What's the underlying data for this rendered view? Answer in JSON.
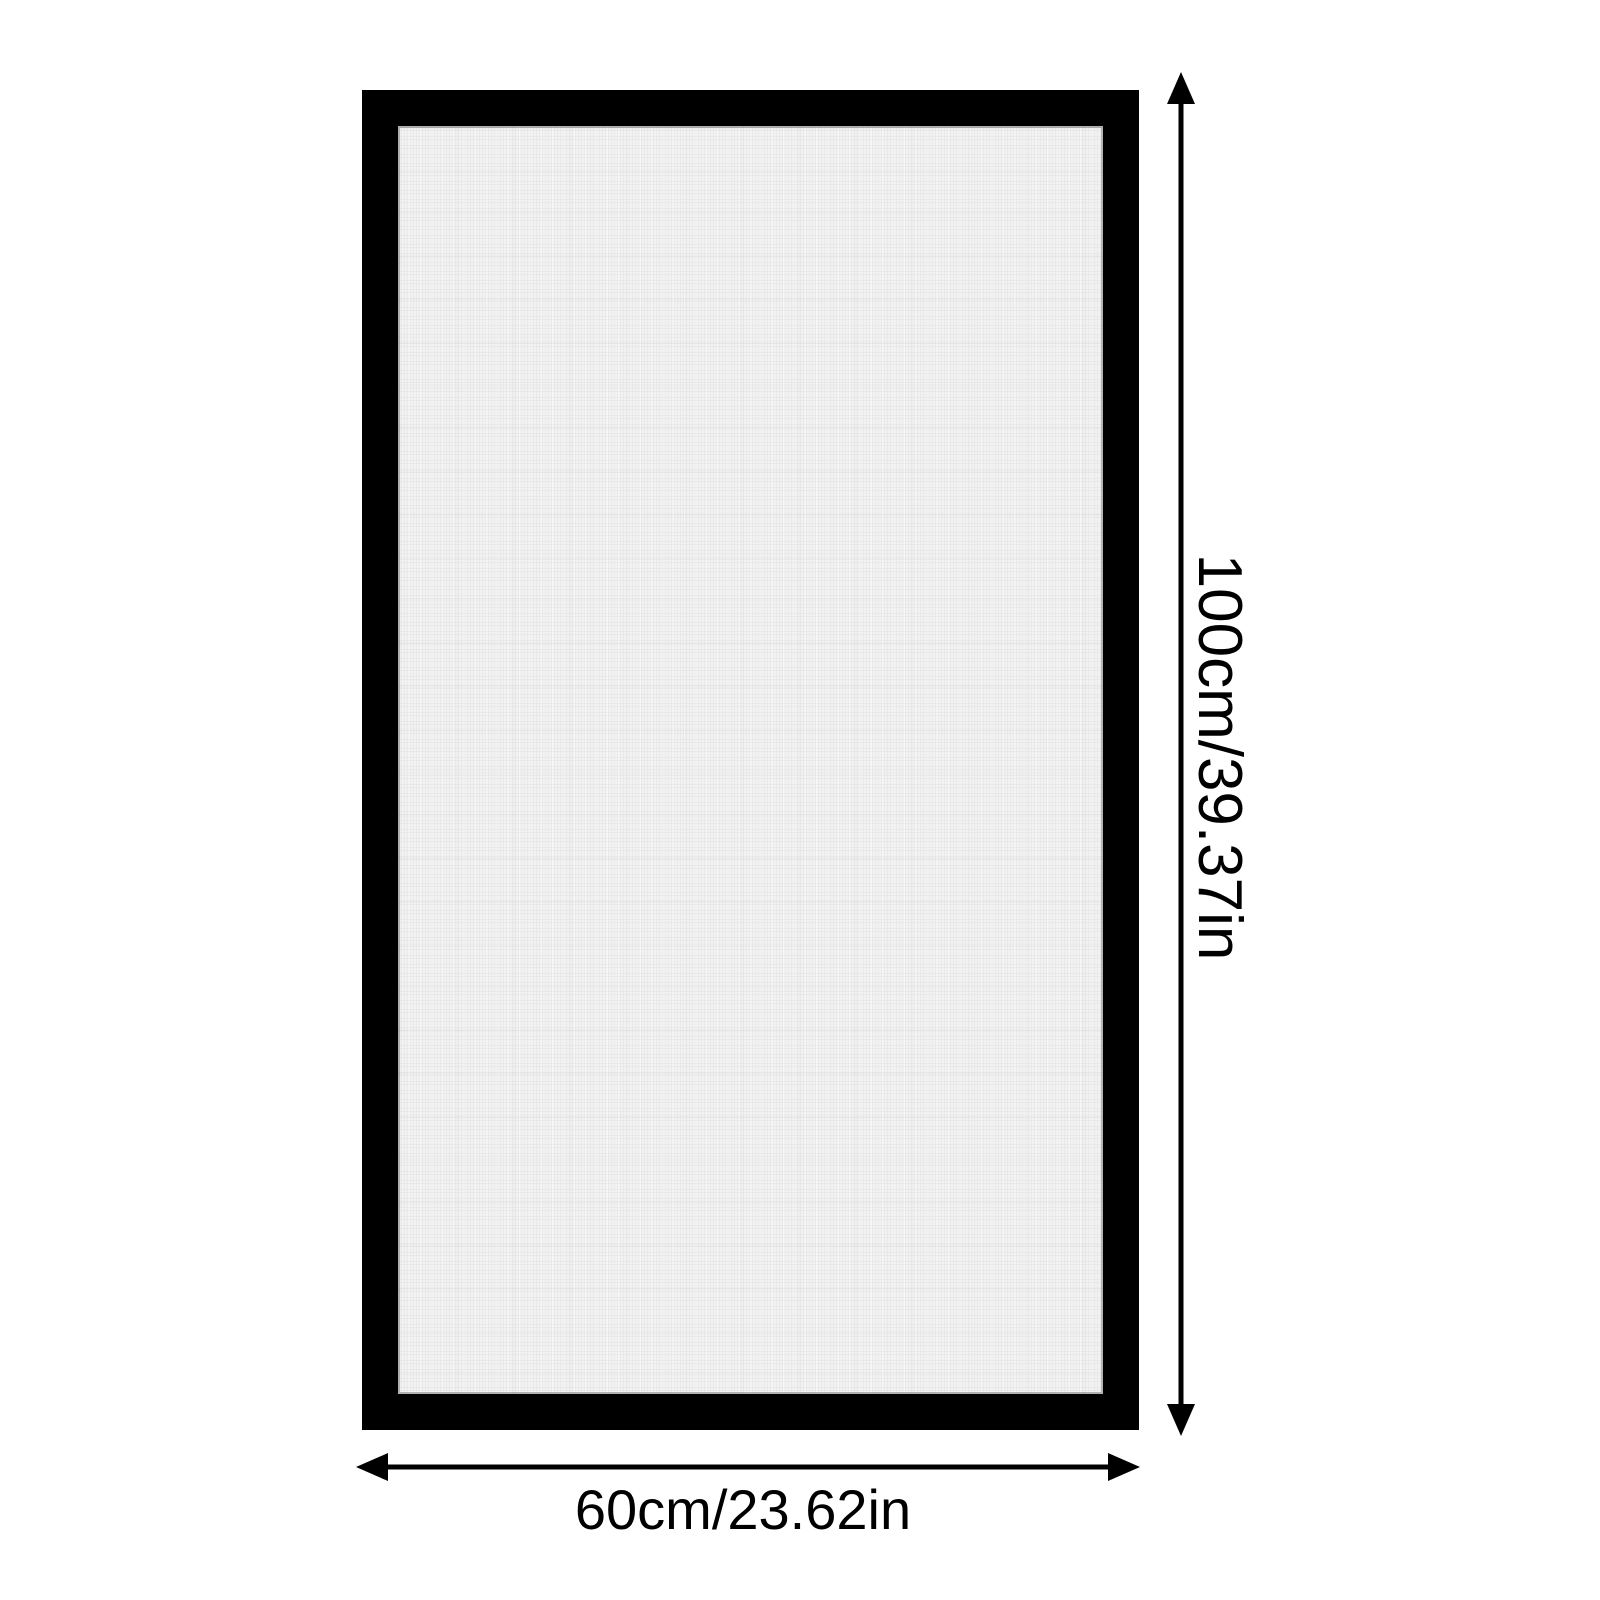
{
  "diagram": {
    "type": "product-dimension-diagram",
    "product": "framed mesh screen panel",
    "height_label": "100cm/39.37in",
    "width_label": "60cm/23.62in",
    "colors": {
      "background": "#ffffff",
      "frame": "#000000",
      "mesh": "#f2f2f2",
      "arrows_and_text": "#000000"
    }
  }
}
